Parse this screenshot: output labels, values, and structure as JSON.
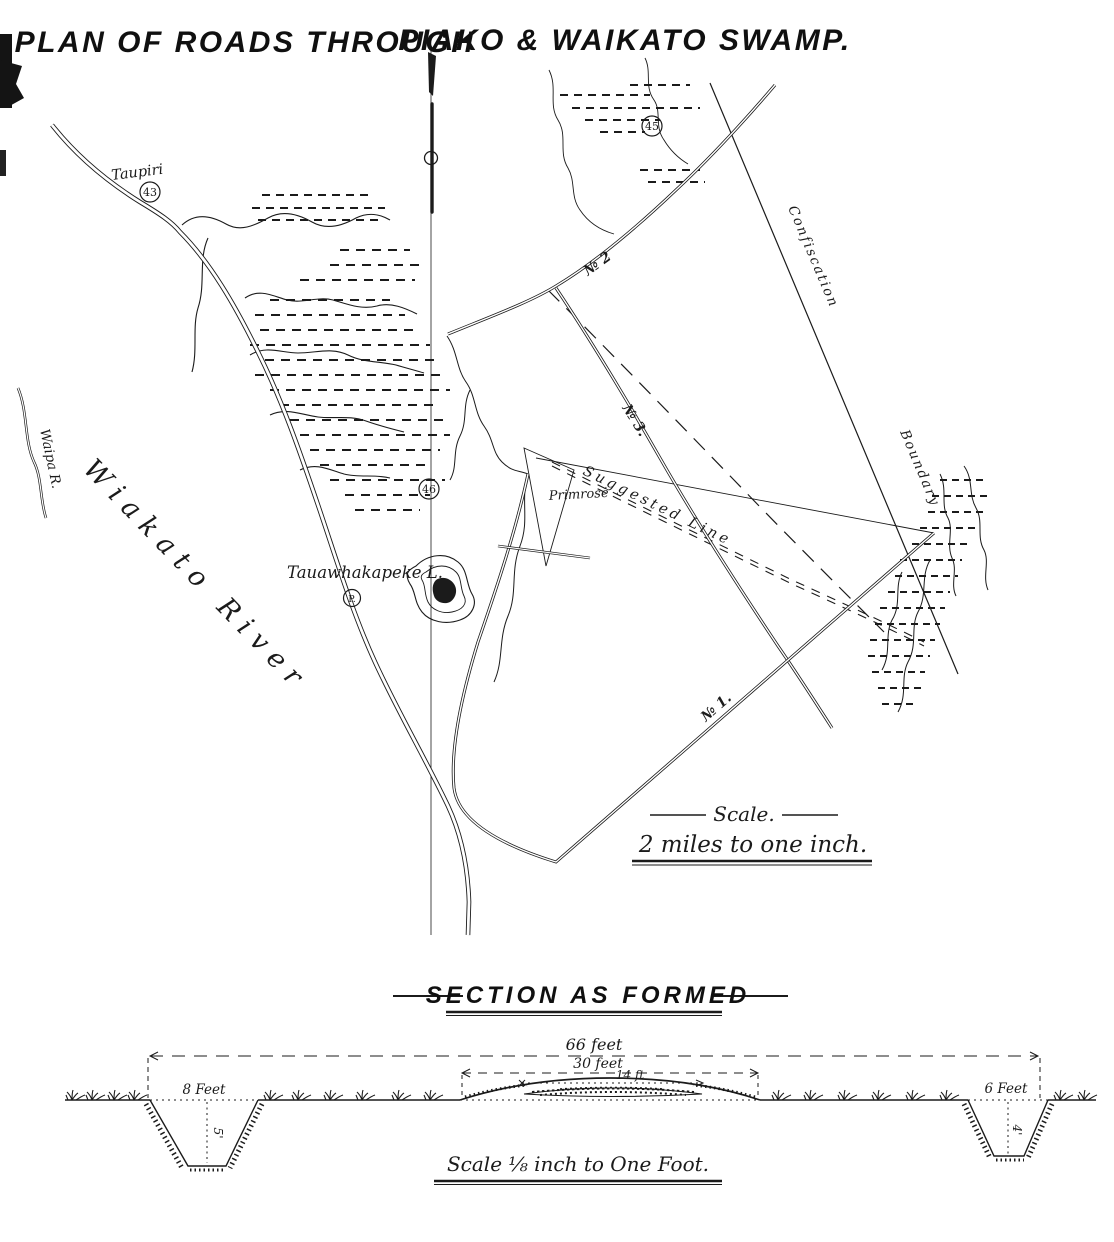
{
  "page": {
    "paper_color": "#ffffff",
    "ink_color": "#1b1b1b"
  },
  "title": {
    "left": "PLAN OF ROADS THROUGH",
    "right": "PIAKO & WAIKATO SWAMP."
  },
  "map": {
    "labels": {
      "taupiri": "Taupiri",
      "circle_43": "43",
      "circle_45": "45",
      "circle_46": "46",
      "circle_p": "P.",
      "road_no2": "№ 2",
      "road_no3": "№ 3.",
      "road_no1": "№ 1.",
      "confiscation": "Confiscation",
      "boundary": "Boundary",
      "suggested_line": "Suggested Line",
      "primrose": "Primrose",
      "lake": "Tauawhakapeke L.",
      "river": "Wiakato River",
      "waipa": "Waipa R."
    },
    "scale": {
      "heading": "Scale.",
      "text": "2 miles to one inch."
    }
  },
  "section": {
    "heading": "SECTION AS FORMED",
    "dimensions": {
      "total_width": "66 feet",
      "formed_width": "30 feet",
      "metal_width": "14 ft",
      "left_ditch_width": "8 Feet",
      "left_ditch_depth": "5'",
      "right_ditch_width": "6 Feet",
      "right_ditch_depth": "4'"
    },
    "scale_note": "Scale ⅛ inch to One Foot."
  }
}
